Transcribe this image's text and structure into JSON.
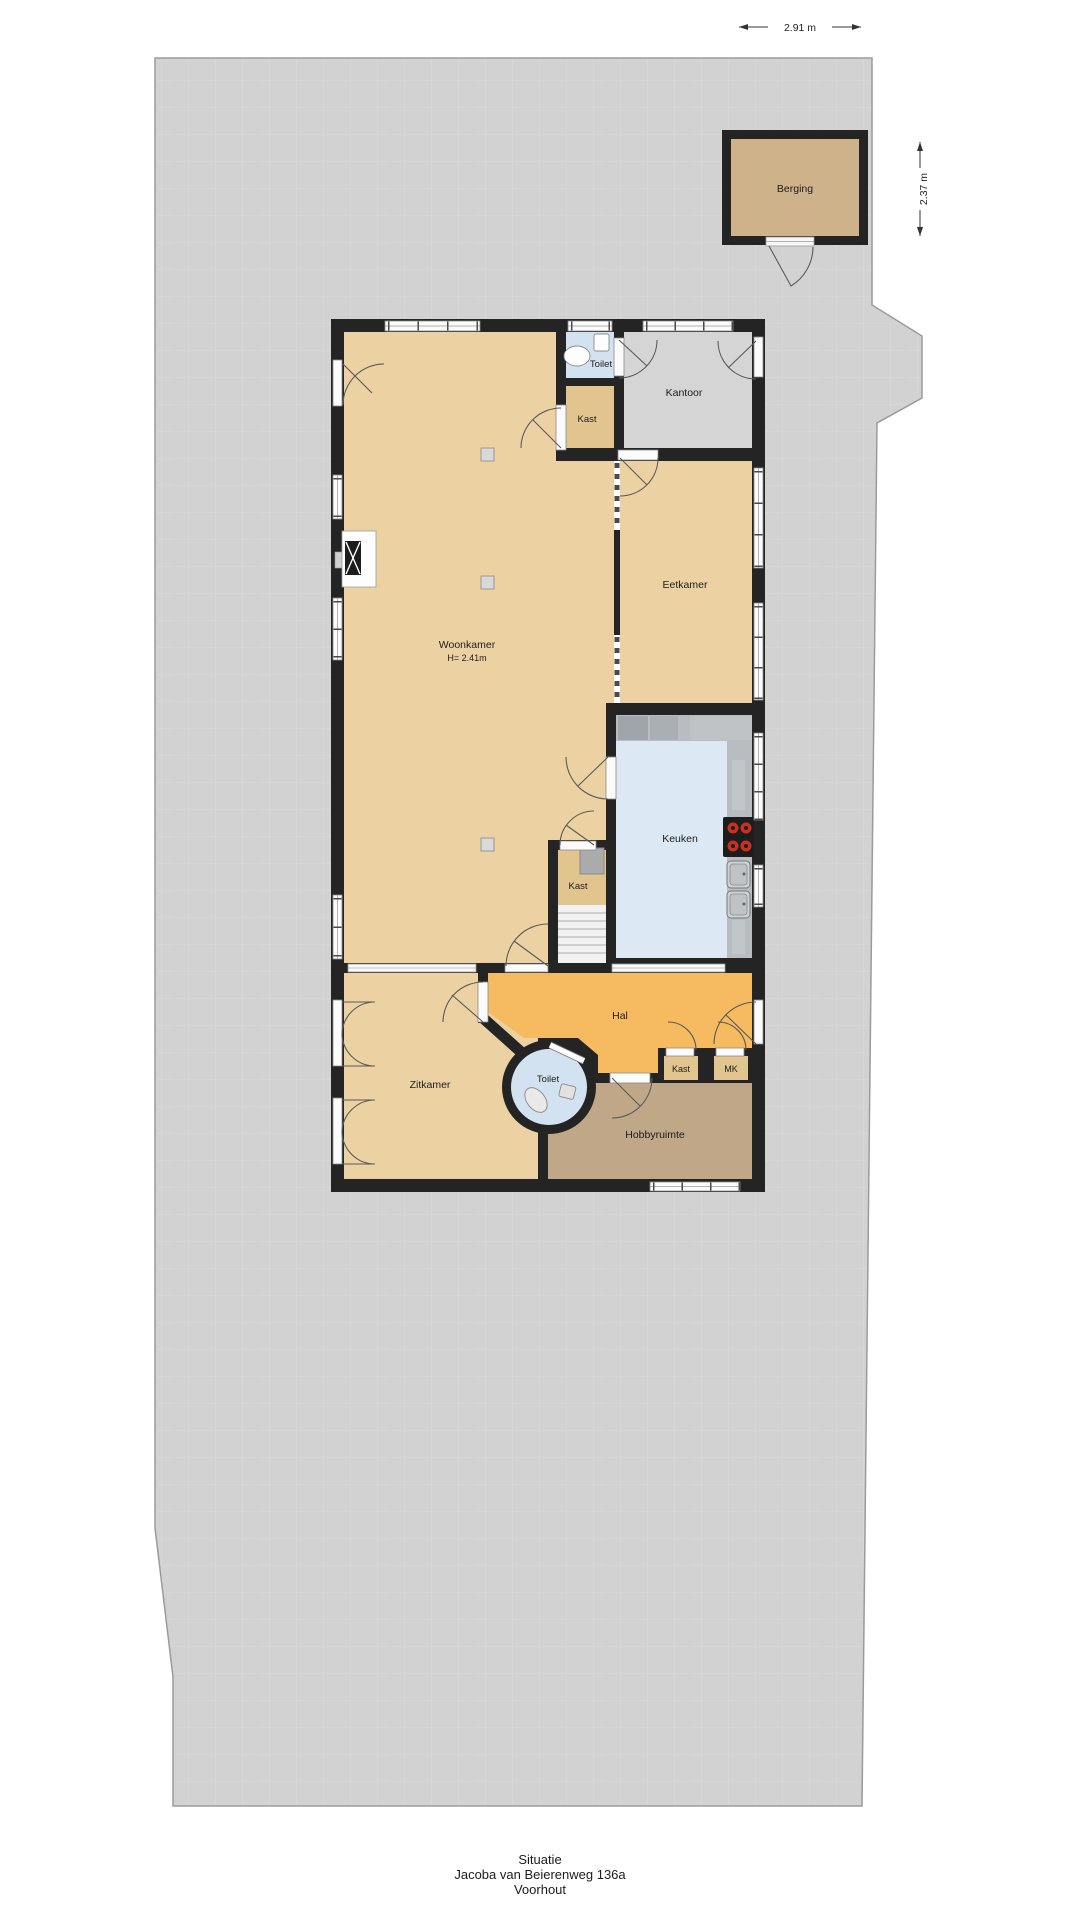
{
  "footer": {
    "line1": "Situatie",
    "line2": "Jacoba van Beierenweg 136a",
    "line3": "Voorhout"
  },
  "dimensions": {
    "top_width": "2.91 m",
    "right_height": "2.37 m"
  },
  "outbuilding": {
    "berging": {
      "label": "Berging"
    }
  },
  "rooms": {
    "woonkamer": {
      "label": "Woonkamer",
      "ceiling_height": "H= 2.41m"
    },
    "toilet_top": {
      "label": "Toilet"
    },
    "kast_top": {
      "label": "Kast"
    },
    "kantoor": {
      "label": "Kantoor"
    },
    "eetkamer": {
      "label": "Eetkamer"
    },
    "keuken": {
      "label": "Keuken"
    },
    "kast_mid": {
      "label": "Kast"
    },
    "hal": {
      "label": "Hal"
    },
    "zitkamer": {
      "label": "Zitkamer"
    },
    "toilet_bottom": {
      "label": "Toilet"
    },
    "kast_bottom": {
      "label": "Kast"
    },
    "mk": {
      "label": "MK"
    },
    "hobbyruimte": {
      "label": "Hobbyruimte"
    }
  },
  "colors": {
    "plot_gray": "#d2d2d2",
    "wall_black": "#242424",
    "living_tan": "#ecd2a3",
    "closet_tan": "#e2c48f",
    "shed_tan": "#cdb28a",
    "hobby_brown": "#c0a787",
    "hall_orange": "#f6ba61",
    "wet_room_blue": "#d3e2f1",
    "kitchen_blue": "#dce8f4",
    "office_gray": "#d5d5d5",
    "counter_gray": "#b9bdc1",
    "burner_red": "#c8311f"
  }
}
